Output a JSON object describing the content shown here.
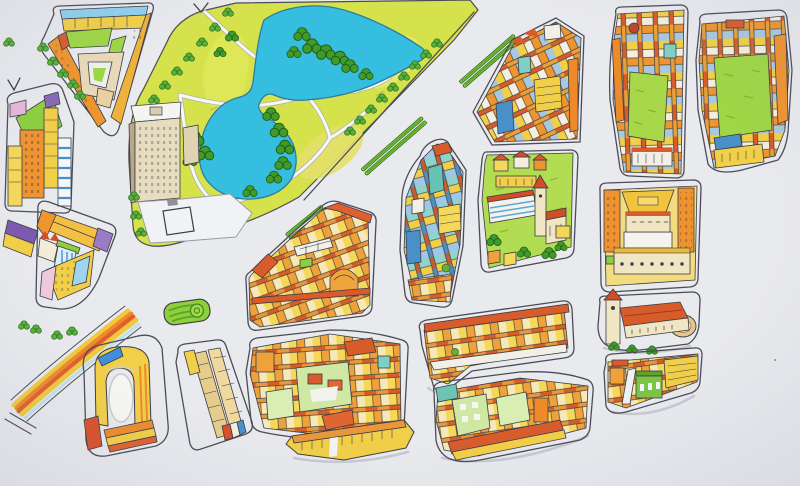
{
  "scene": {
    "title": "Hand-drawn illustrated city map",
    "description": "Ink and marker bird's-eye illustration of a city district: a park with a lake, a diagonal boulevard with planted medians, tree-lined avenues and colorful building blocks. No text labels are drawn.",
    "style": "isometric sketch on light paper"
  },
  "palette": {
    "paper": "#e9eaee",
    "ink": "#3c3c46",
    "street_line": "#4c4c56",
    "park_grass": "#d6e24c",
    "park_grass_light": "#e6ea72",
    "lake": "#35bedf",
    "lake_outline": "#2f7c9c",
    "path_white": "#f6f7f9",
    "tree_dark": "#3f9b2b",
    "tree_light": "#55b13a",
    "garden_green": "#b2dc52",
    "roundabout_green": "#8fcf3a",
    "median_fill": "#8fcf3a",
    "median_stripe": "#4e9a2f",
    "roof_red": "#d85b2b",
    "roof_deep": "#cf4e27",
    "roof_blue": "#8fd0ee",
    "facade_yellow": "#f2cf48",
    "facade_orange": "#ee8a2a",
    "facade_cream": "#f1e6c4",
    "facade_teal": "#7fd0c4",
    "facade_blue": "#4a90c8",
    "facade_purple": "#8868b8",
    "facade_pink": "#f0c8dc",
    "rail_yellow": "#f0c93e",
    "rail_orange": "#ee8a2a",
    "rail_deep_orange": "#e05f2e"
  },
  "park": {
    "name": "city-park",
    "lake": "irregular two-lobed cyan pond",
    "lawns": "yellow-green with lighter patches",
    "groves": "dark green tree clusters on shores",
    "paths": "white walking paths with a small loop",
    "avenues": "tree-lined streets on west and southeast edges"
  },
  "landmarks": [
    {
      "id": "hotel-building",
      "label": "tall cream hotel slab at the park corner with plaza and square forecourt"
    },
    {
      "id": "roundabout",
      "label": "oval green traffic island with spiral lawn"
    },
    {
      "id": "railway-tracks",
      "label": "curved bundle of yellow-orange tracks, bottom-left"
    },
    {
      "id": "amphitheater",
      "label": "yellow horseshoe venue with blue band and striped annexes"
    },
    {
      "id": "palace-block",
      "label": "yellow palace with grand hipped roof and twin orange wings"
    },
    {
      "id": "basilica-block",
      "label": "long hall with red tiled roof, west tower and round east apse"
    },
    {
      "id": "garden-block",
      "label": "green campus with white arcade, church tower and red-roofed houses"
    }
  ],
  "boulevard": {
    "label": "wide diagonal boulevard southeast of the park",
    "median_segments": 3
  },
  "street_markings": {
    "chevrons": 2,
    "parallel_dashes": 2
  },
  "street_trees": {
    "rows": 4,
    "approx_count": 28
  },
  "blocks": [
    {
      "id": "block-nw-triangle",
      "label": "triangular block, blue roofs, green courtyards, beige inner ring",
      "colors": [
        "#f2cf48",
        "#ee9530",
        "#8fd0ee",
        "#9ed645",
        "#ead9b8"
      ]
    },
    {
      "id": "block-west-towers",
      "label": "west-edge tower block with lawn wedge and striped tower",
      "colors": [
        "#ef9330",
        "#f2cf48",
        "#4a90c8",
        "#8ccf3e"
      ]
    },
    {
      "id": "block-west-triangle",
      "label": "small triangle block, long amber roof, purple corner",
      "colors": [
        "#f3c043",
        "#8868b8",
        "#9fd3ee",
        "#f0c8dc"
      ]
    },
    {
      "id": "block-center-west",
      "label": "large row-house block with white slab and orange dome",
      "colors": [
        "#d85b2b",
        "#f2cf48",
        "#efa23c"
      ]
    },
    {
      "id": "block-center",
      "label": "tall dense block, teal and blue towers",
      "colors": [
        "#7fd0c4",
        "#f2cf48",
        "#9fc8e8",
        "#c95a2e"
      ]
    },
    {
      "id": "block-center-strip",
      "label": "slanted strip block, yellow facades, red roof line",
      "colors": [
        "#f2cf48",
        "#d85b2b"
      ]
    },
    {
      "id": "block-garden-north",
      "label": "dense block north of the gardens",
      "colors": [
        "#f2cf48",
        "#ee9530",
        "#4a90c8"
      ]
    },
    {
      "id": "block-ne-inner",
      "label": "courtyard block with small red dome",
      "colors": [
        "#f2cf48",
        "#ee8a2a",
        "#a8d84a"
      ]
    },
    {
      "id": "block-ne-outer",
      "label": "east-edge courtyard block",
      "colors": [
        "#f2cf48",
        "#ef9330",
        "#9ed645"
      ]
    },
    {
      "id": "block-se-small",
      "label": "small block with green arched hall",
      "colors": [
        "#f2cf48",
        "#7cc444"
      ]
    },
    {
      "id": "block-south-courtyards",
      "label": "block with pale-green courtyard buildings",
      "colors": [
        "#d85b2b",
        "#f2cf48",
        "#cfe8a4"
      ]
    },
    {
      "id": "block-south-center",
      "label": "dense block with pale-green slabs and teal corner",
      "colors": [
        "#cfe8a4",
        "#ee8a2a",
        "#d85b2b"
      ]
    },
    {
      "id": "block-south-strip",
      "label": "narrow yellow strip block",
      "colors": [
        "#f2cf48",
        "#e8973a"
      ]
    },
    {
      "id": "slab-block",
      "label": "elongated twin-slab building in own street loop",
      "colors": [
        "#e6cd8c",
        "#efd9a0"
      ]
    }
  ]
}
